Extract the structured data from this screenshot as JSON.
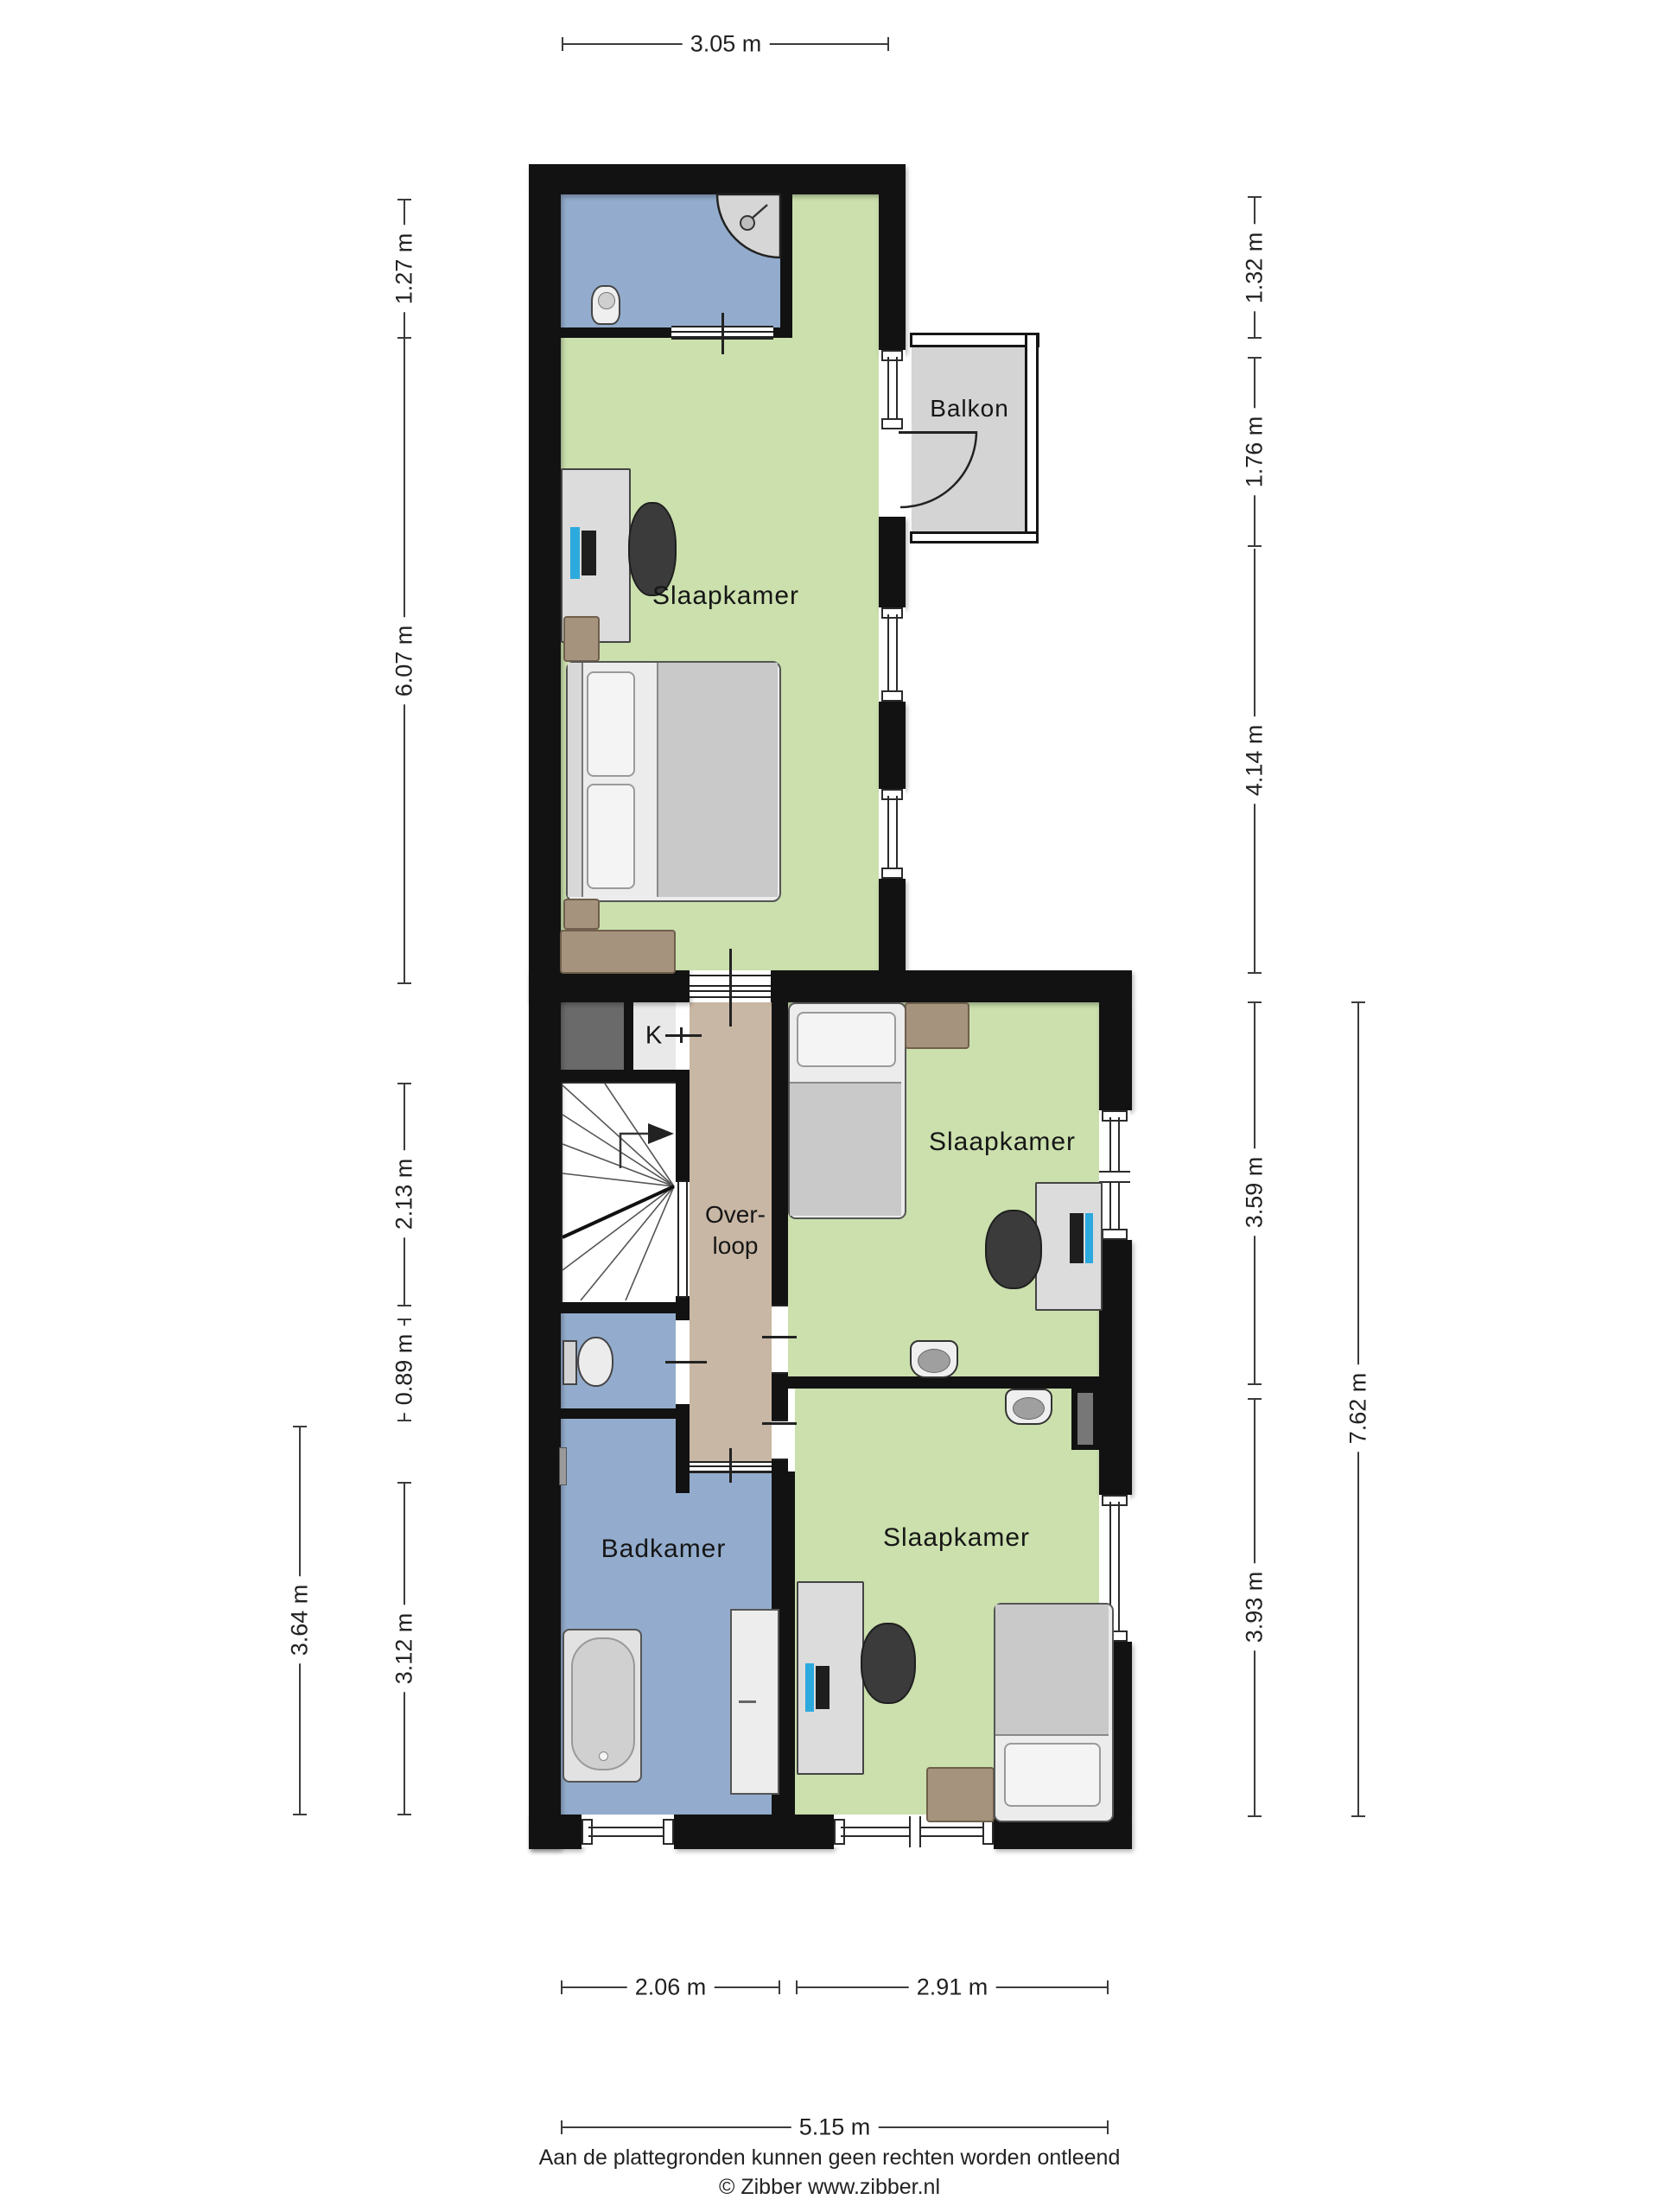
{
  "rooms": {
    "bedroom_top": "Slaapkamer",
    "balcony": "Balkon",
    "bedroom_middle": "Slaapkamer",
    "landing_line1": "Over-",
    "landing_line2": "loop",
    "closet": "K",
    "bathroom": "Badkamer",
    "bedroom_bottom": "Slaapkamer"
  },
  "dimensions": {
    "top": {
      "total": "3.05 m"
    },
    "left": {
      "shower_room": "1.27 m",
      "bedroom": "6.07 m",
      "stairs": "2.13 m",
      "toilet": "0.89 m",
      "bathroom": "3.12 m",
      "bathroom_outer": "3.64 m"
    },
    "right": {
      "top": "1.32 m",
      "balcony": "1.76 m",
      "bedroom": "4.14 m",
      "bedroom_middle": "3.59 m",
      "bedroom_bottom": "3.93 m",
      "total": "7.62 m"
    },
    "bottom": {
      "bathroom": "2.06 m",
      "bedroom": "2.91 m",
      "total": "5.15 m"
    }
  },
  "footer": {
    "line1": "Aan de plattegronden kunnen geen rechten worden ontleend",
    "line2": "© Zibber www.zibber.nl"
  },
  "colors": {
    "wall": "#121212",
    "room_green": "#cbe0ad",
    "room_blue": "#93accd",
    "landing_tan": "#c8b7a4",
    "balcony_grey": "#d4d4d4",
    "monitor_accent": "#2ca9dd"
  }
}
